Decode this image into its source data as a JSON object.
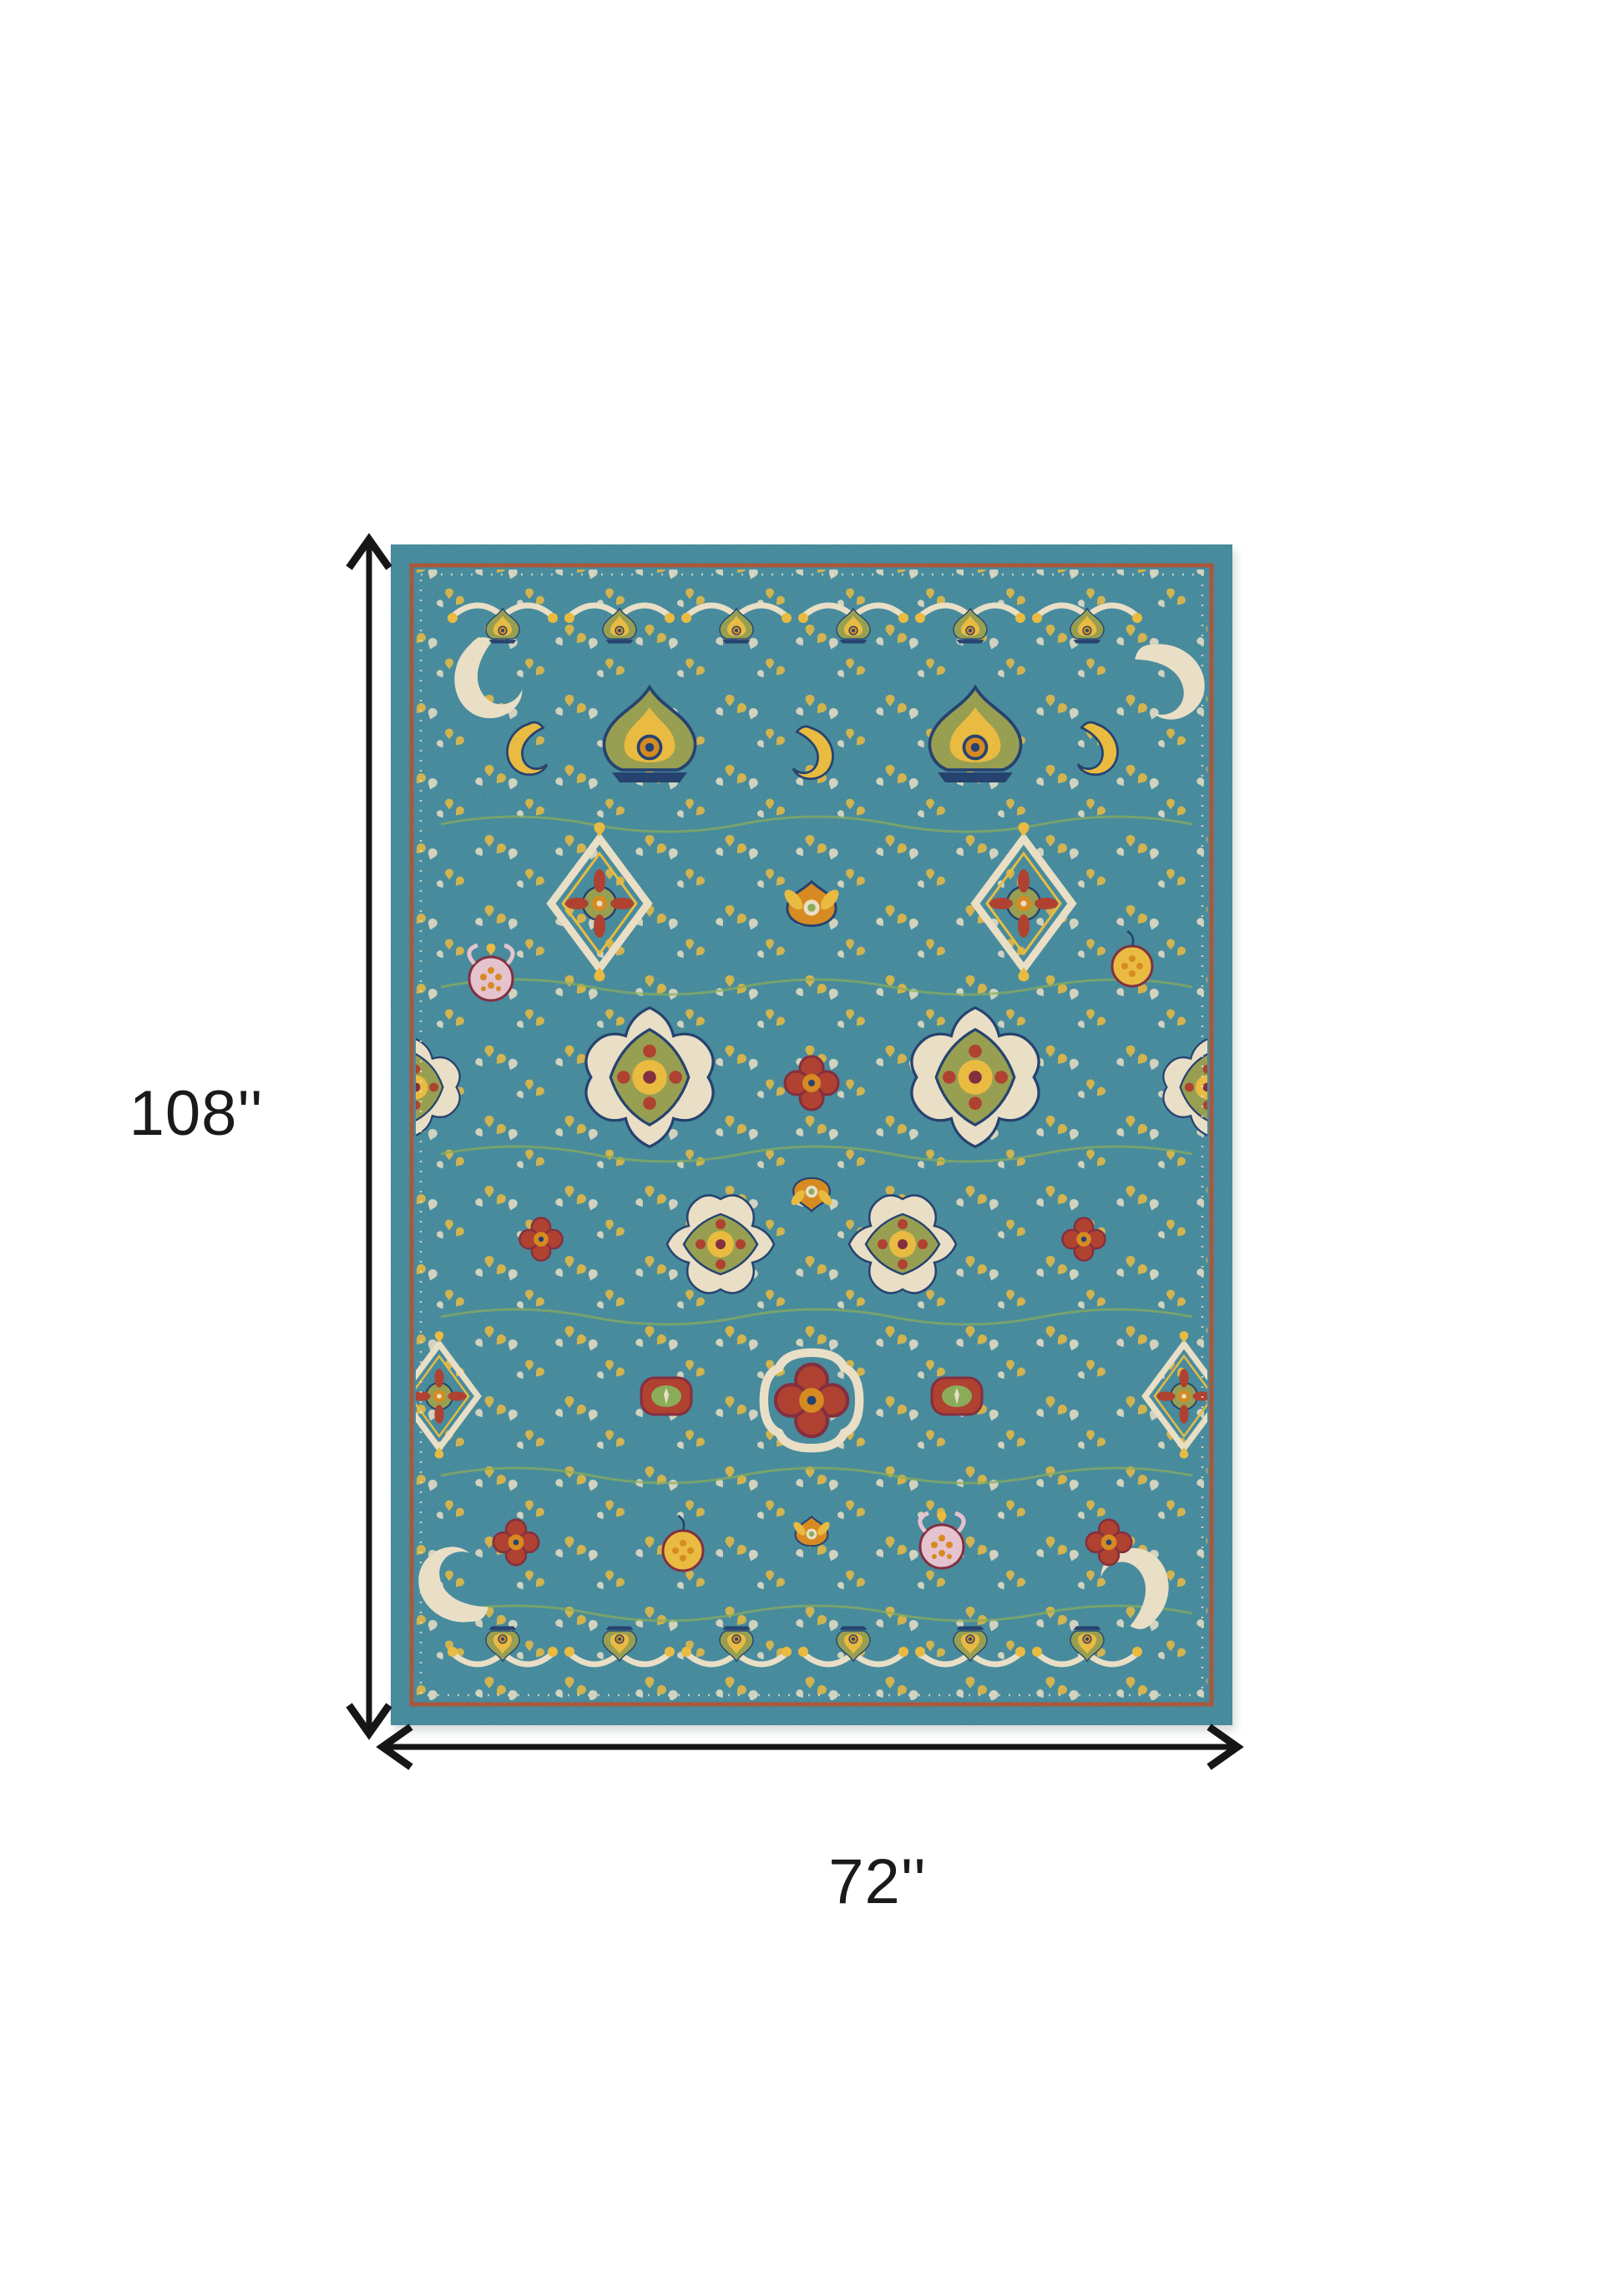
{
  "diagram": {
    "title": "rug-dimension-diagram",
    "height_dimension": {
      "label": "108''"
    },
    "width_dimension": {
      "label": "72''"
    }
  },
  "rug": {
    "name": "teal-multicolor-persian-floral-rug"
  },
  "colors": {
    "teal": "#45879a",
    "teal_dark": "#336e80",
    "teal_light": "#63a3af",
    "rust": "#a8543a",
    "cream": "#ece1c6",
    "gold": "#ecba3e",
    "orange": "#d8861f",
    "olive": "#949c4e",
    "navy": "#24406b",
    "red": "#ae3f2e",
    "maroon": "#7e2d3d",
    "pink": "#e7c3cf",
    "green": "#86ab56",
    "arrow": "#161616",
    "label": "#1a1a1a"
  }
}
